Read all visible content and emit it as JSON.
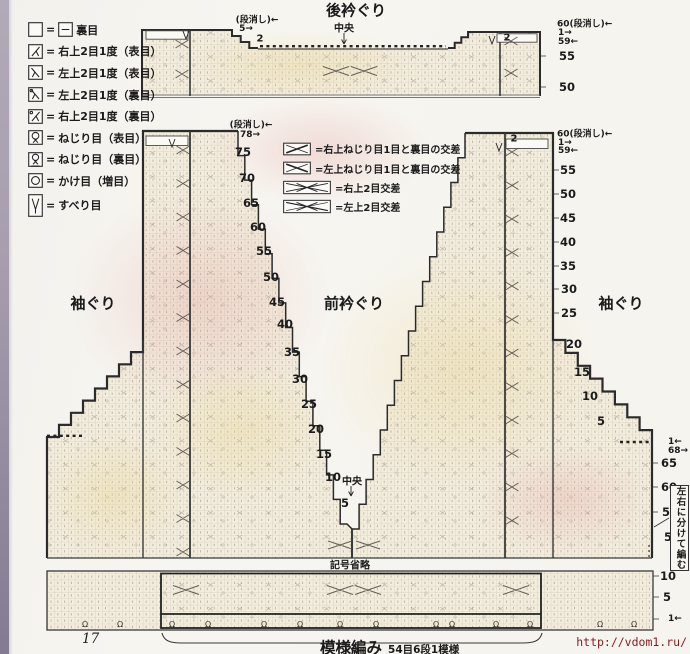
{
  "stitch_legend": {
    "items": [
      {
        "sym": "blank",
        "sym2": "dash",
        "text": "裏目"
      },
      {
        "sym": "k2r",
        "text": "右上2目1度（表目）"
      },
      {
        "sym": "k2l",
        "text": "左上2目1度（表目）"
      },
      {
        "sym": "p2l",
        "text": "左上2目1度（裏目）"
      },
      {
        "sym": "p2r",
        "text": "右上2目1度（裏目）"
      },
      {
        "sym": "tw",
        "text": "ねじり目（表目）"
      },
      {
        "sym": "twp",
        "text": "ねじり目（裏目）"
      },
      {
        "sym": "yo",
        "text": "かけ目（増目）"
      },
      {
        "sym": "slip",
        "text": "すべり目"
      }
    ]
  },
  "cable_legend": {
    "items": [
      {
        "sym": "tcr",
        "text": "右上ねじり目1目と裏目の交差"
      },
      {
        "sym": "tcl",
        "text": "左上ねじり目1目と裏目の交差"
      },
      {
        "sym": "c2r",
        "text": "右上2目交差"
      },
      {
        "sym": "c2l",
        "text": "左上2目交差"
      }
    ]
  },
  "labels": [
    {
      "t": "後衿ぐり",
      "x": 356,
      "y": 10,
      "k": "title"
    },
    {
      "t": "(段消し)←",
      "x": 257,
      "y": 19,
      "k": "small"
    },
    {
      "t": "5→",
      "x": 246,
      "y": 29,
      "k": "small"
    },
    {
      "t": "2",
      "x": 260,
      "y": 39,
      "k": "smallb"
    },
    {
      "t": "中央",
      "x": 344,
      "y": 27,
      "k": "smallb"
    },
    {
      "t": "2",
      "x": 507,
      "y": 38,
      "k": "smallb"
    },
    {
      "t": "60(段消し)←",
      "x": 557,
      "y": 23,
      "k": "smalll"
    },
    {
      "t": "1→",
      "x": 558,
      "y": 33,
      "k": "smalll"
    },
    {
      "t": "59←",
      "x": 558,
      "y": 42,
      "k": "smalll"
    },
    {
      "t": "55",
      "x": 559,
      "y": 56,
      "k": "numl"
    },
    {
      "t": "50",
      "x": 559,
      "y": 87,
      "k": "numl"
    },
    {
      "t": "(段消し)←",
      "x": 251,
      "y": 124,
      "k": "small"
    },
    {
      "t": "78→",
      "x": 240,
      "y": 135,
      "k": "smalll"
    },
    {
      "t": "75",
      "x": 243,
      "y": 152,
      "k": "num"
    },
    {
      "t": "70",
      "x": 247,
      "y": 178,
      "k": "num"
    },
    {
      "t": "65",
      "x": 251,
      "y": 203,
      "k": "num"
    },
    {
      "t": "60",
      "x": 258,
      "y": 227,
      "k": "num"
    },
    {
      "t": "55",
      "x": 264,
      "y": 251,
      "k": "num"
    },
    {
      "t": "50",
      "x": 271,
      "y": 277,
      "k": "num"
    },
    {
      "t": "45",
      "x": 277,
      "y": 302,
      "k": "num"
    },
    {
      "t": "40",
      "x": 285,
      "y": 324,
      "k": "num"
    },
    {
      "t": "35",
      "x": 292,
      "y": 352,
      "k": "num"
    },
    {
      "t": "30",
      "x": 300,
      "y": 379,
      "k": "num"
    },
    {
      "t": "25",
      "x": 309,
      "y": 404,
      "k": "num"
    },
    {
      "t": "20",
      "x": 316,
      "y": 429,
      "k": "num"
    },
    {
      "t": "15",
      "x": 324,
      "y": 454,
      "k": "num"
    },
    {
      "t": "10",
      "x": 333,
      "y": 477,
      "k": "num"
    },
    {
      "t": "5",
      "x": 345,
      "y": 503,
      "k": "num"
    },
    {
      "t": "前衿ぐり",
      "x": 354,
      "y": 303,
      "k": "title"
    },
    {
      "t": "袖ぐり",
      "x": 93,
      "y": 303,
      "k": "title"
    },
    {
      "t": "袖ぐり",
      "x": 621,
      "y": 303,
      "k": "title"
    },
    {
      "t": "中央",
      "x": 352,
      "y": 480,
      "k": "smallb"
    },
    {
      "t": "2",
      "x": 514,
      "y": 139,
      "k": "smallb"
    },
    {
      "t": "60(段消し)←",
      "x": 557,
      "y": 133,
      "k": "smalll"
    },
    {
      "t": "1→",
      "x": 558,
      "y": 143,
      "k": "smalll"
    },
    {
      "t": "59←",
      "x": 558,
      "y": 151,
      "k": "smalll"
    },
    {
      "t": "55",
      "x": 560,
      "y": 170,
      "k": "numl"
    },
    {
      "t": "50",
      "x": 560,
      "y": 194,
      "k": "numl"
    },
    {
      "t": "45",
      "x": 560,
      "y": 218,
      "k": "numl"
    },
    {
      "t": "40",
      "x": 560,
      "y": 242,
      "k": "numl"
    },
    {
      "t": "35",
      "x": 560,
      "y": 266,
      "k": "numl"
    },
    {
      "t": "30",
      "x": 561,
      "y": 289,
      "k": "numl"
    },
    {
      "t": "25",
      "x": 561,
      "y": 313,
      "k": "numl"
    },
    {
      "t": "20",
      "x": 566,
      "y": 344,
      "k": "numl"
    },
    {
      "t": "15",
      "x": 574,
      "y": 372,
      "k": "numl"
    },
    {
      "t": "10",
      "x": 582,
      "y": 396,
      "k": "numl"
    },
    {
      "t": "5",
      "x": 597,
      "y": 421,
      "k": "numl"
    },
    {
      "t": "1←",
      "x": 668,
      "y": 442,
      "k": "smalll"
    },
    {
      "t": "68→",
      "x": 668,
      "y": 451,
      "k": "smalll"
    },
    {
      "t": "65",
      "x": 661,
      "y": 463,
      "k": "numl"
    },
    {
      "t": "60",
      "x": 661,
      "y": 487,
      "k": "numl"
    },
    {
      "t": "55",
      "x": 662,
      "y": 512,
      "k": "numl"
    },
    {
      "t": "50",
      "x": 664,
      "y": 537,
      "k": "numl"
    },
    {
      "t": "10",
      "x": 660,
      "y": 576,
      "k": "numl"
    },
    {
      "t": "5",
      "x": 663,
      "y": 597,
      "k": "numl"
    },
    {
      "t": "1←",
      "x": 668,
      "y": 619,
      "k": "smalll"
    },
    {
      "t": "記号省略",
      "x": 350,
      "y": 564,
      "k": "smallb"
    }
  ],
  "side_note": {
    "text": "左右に分けて編む"
  },
  "caption": {
    "main": "模様編み",
    "sub": "54目6段1模様"
  },
  "footer": {
    "page_number": "17",
    "url": "http://vdom1.ru/"
  },
  "colors": {
    "paper": "#f6f4ee",
    "fabric": "#f3edde",
    "outline": "#2b2b2b",
    "url_red": "#8b1c1c",
    "edge_strip": "#9c93a4"
  }
}
